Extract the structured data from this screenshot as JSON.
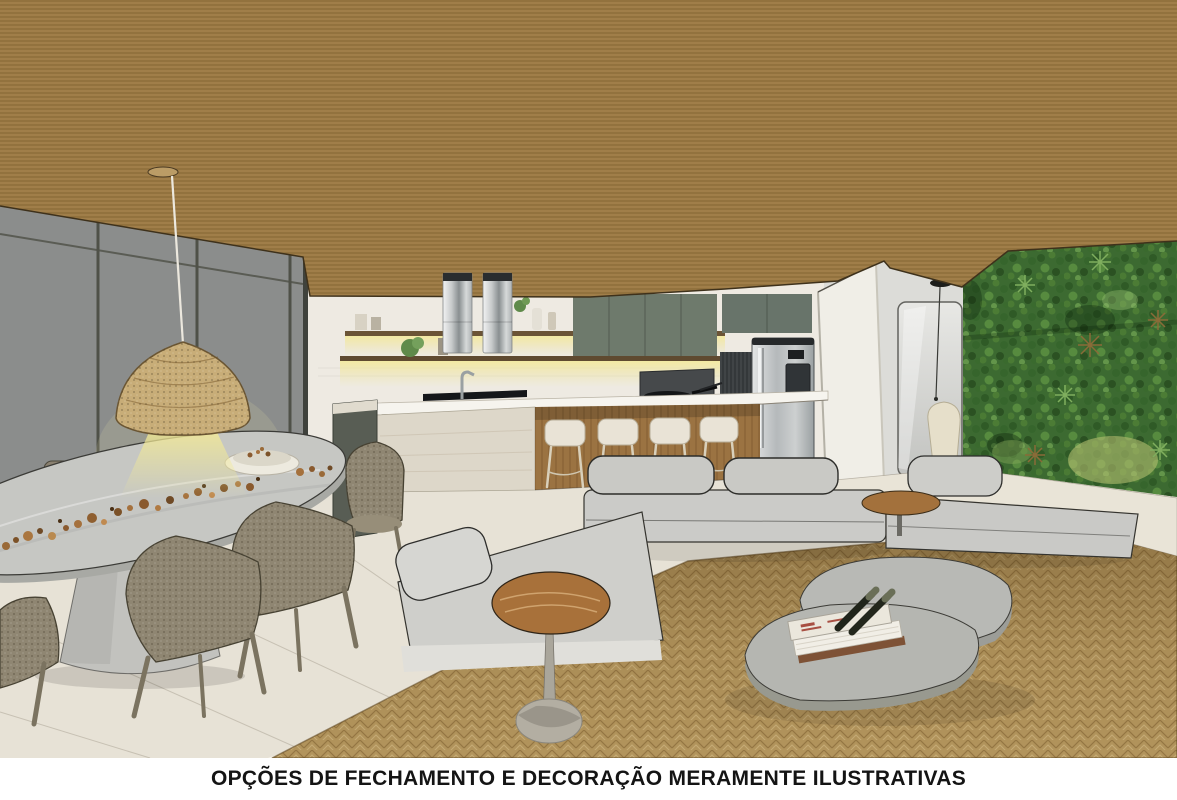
{
  "caption": {
    "text": "OPÇÕES DE FECHAMENTO E DECORAÇÃO MERAMENTE ILUSTRATIVAS"
  },
  "scene": {
    "type": "3d-interior-render",
    "description": "Architectural rendering of an open-plan residence: kitchen with island and bar stools, oval stone dining table with woven chairs and wicker pendant, modular gray sofa on a jute rug, organic stone coffee tables and a vertical garden wall",
    "elements": [
      "wood-slat-ceiling",
      "glass-partition-wall",
      "pendant-wicker-lamp",
      "oval-dining-table",
      "dining-chairs",
      "kitchen-island",
      "bar-stools",
      "range-hoods",
      "upper-cabinets",
      "floating-shelves",
      "refrigerator",
      "grill-counter",
      "hallway-door",
      "hanging-cocoon-chair",
      "vertical-garden-wall",
      "modular-sofa",
      "round-side-table",
      "stone-coffee-tables",
      "jute-rug",
      "tile-floor",
      "decor-books"
    ],
    "colors": {
      "ceiling_wood": "#9c7a44",
      "glass_wall_gray": "#8b8d8c",
      "kitchen_wall": "#eeeae2",
      "cabinet_green": "#6e7a6c",
      "island_wood": "#9b7342",
      "island_stone": "#ddd7c9",
      "counter_top": "#f6f4ee",
      "sofa_gray": "#cbcbc8",
      "rug_tan": "#b2945c",
      "floor_cream": "#e7e2d6",
      "garden_green": "#3c6a31",
      "dining_table_concrete": "#c6c7c3",
      "chair_weave": "#8f8672",
      "pendant_wicker": "#c8ad78",
      "stainless_steel": "#b9bcbd",
      "caption_bg": "#ffffff",
      "caption_text": "#141414"
    }
  }
}
